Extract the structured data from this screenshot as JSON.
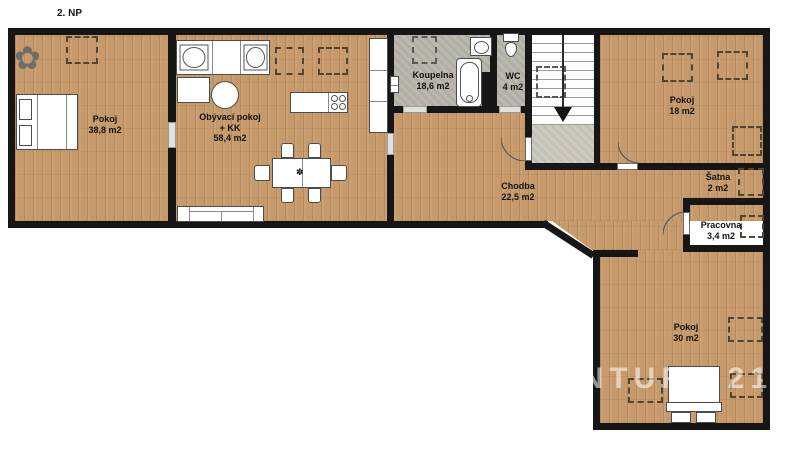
{
  "floor_label": "2. NP",
  "watermark": "CENTURY 21",
  "rooms": {
    "pokoj_left": {
      "name": "Pokoj",
      "area": "38,8 m2"
    },
    "obyvaci_pokoj": {
      "name": "Obývací pokoj",
      "name_suffix": "+ KK",
      "area": "58,4 m2"
    },
    "koupelna": {
      "name": "Koupelna",
      "area": "18,6 m2"
    },
    "wc": {
      "name": "WC",
      "area": "4 m2"
    },
    "pokoj_top_right": {
      "name": "Pokoj",
      "area": "18 m2"
    },
    "chodba": {
      "name": "Chodba",
      "area": "22,5 m2"
    },
    "satna": {
      "name": "Šatna",
      "area": "2 m2"
    },
    "pracovna": {
      "name": "Pracovna",
      "area": "3,4 m2"
    },
    "pokoj_bottom_right": {
      "name": "Pokoj",
      "area": "30 m2"
    }
  },
  "icons": {
    "plant": "✿",
    "table_centerpiece": "✽"
  },
  "colors": {
    "wall": "#161616",
    "wood_floor": "#c79a6b",
    "tile_floor": "#b7b4ab",
    "stair_landing": "#c9c6bb",
    "stairs": "#fdfdfd",
    "watermark": "rgba(255,255,255,0.55)"
  }
}
